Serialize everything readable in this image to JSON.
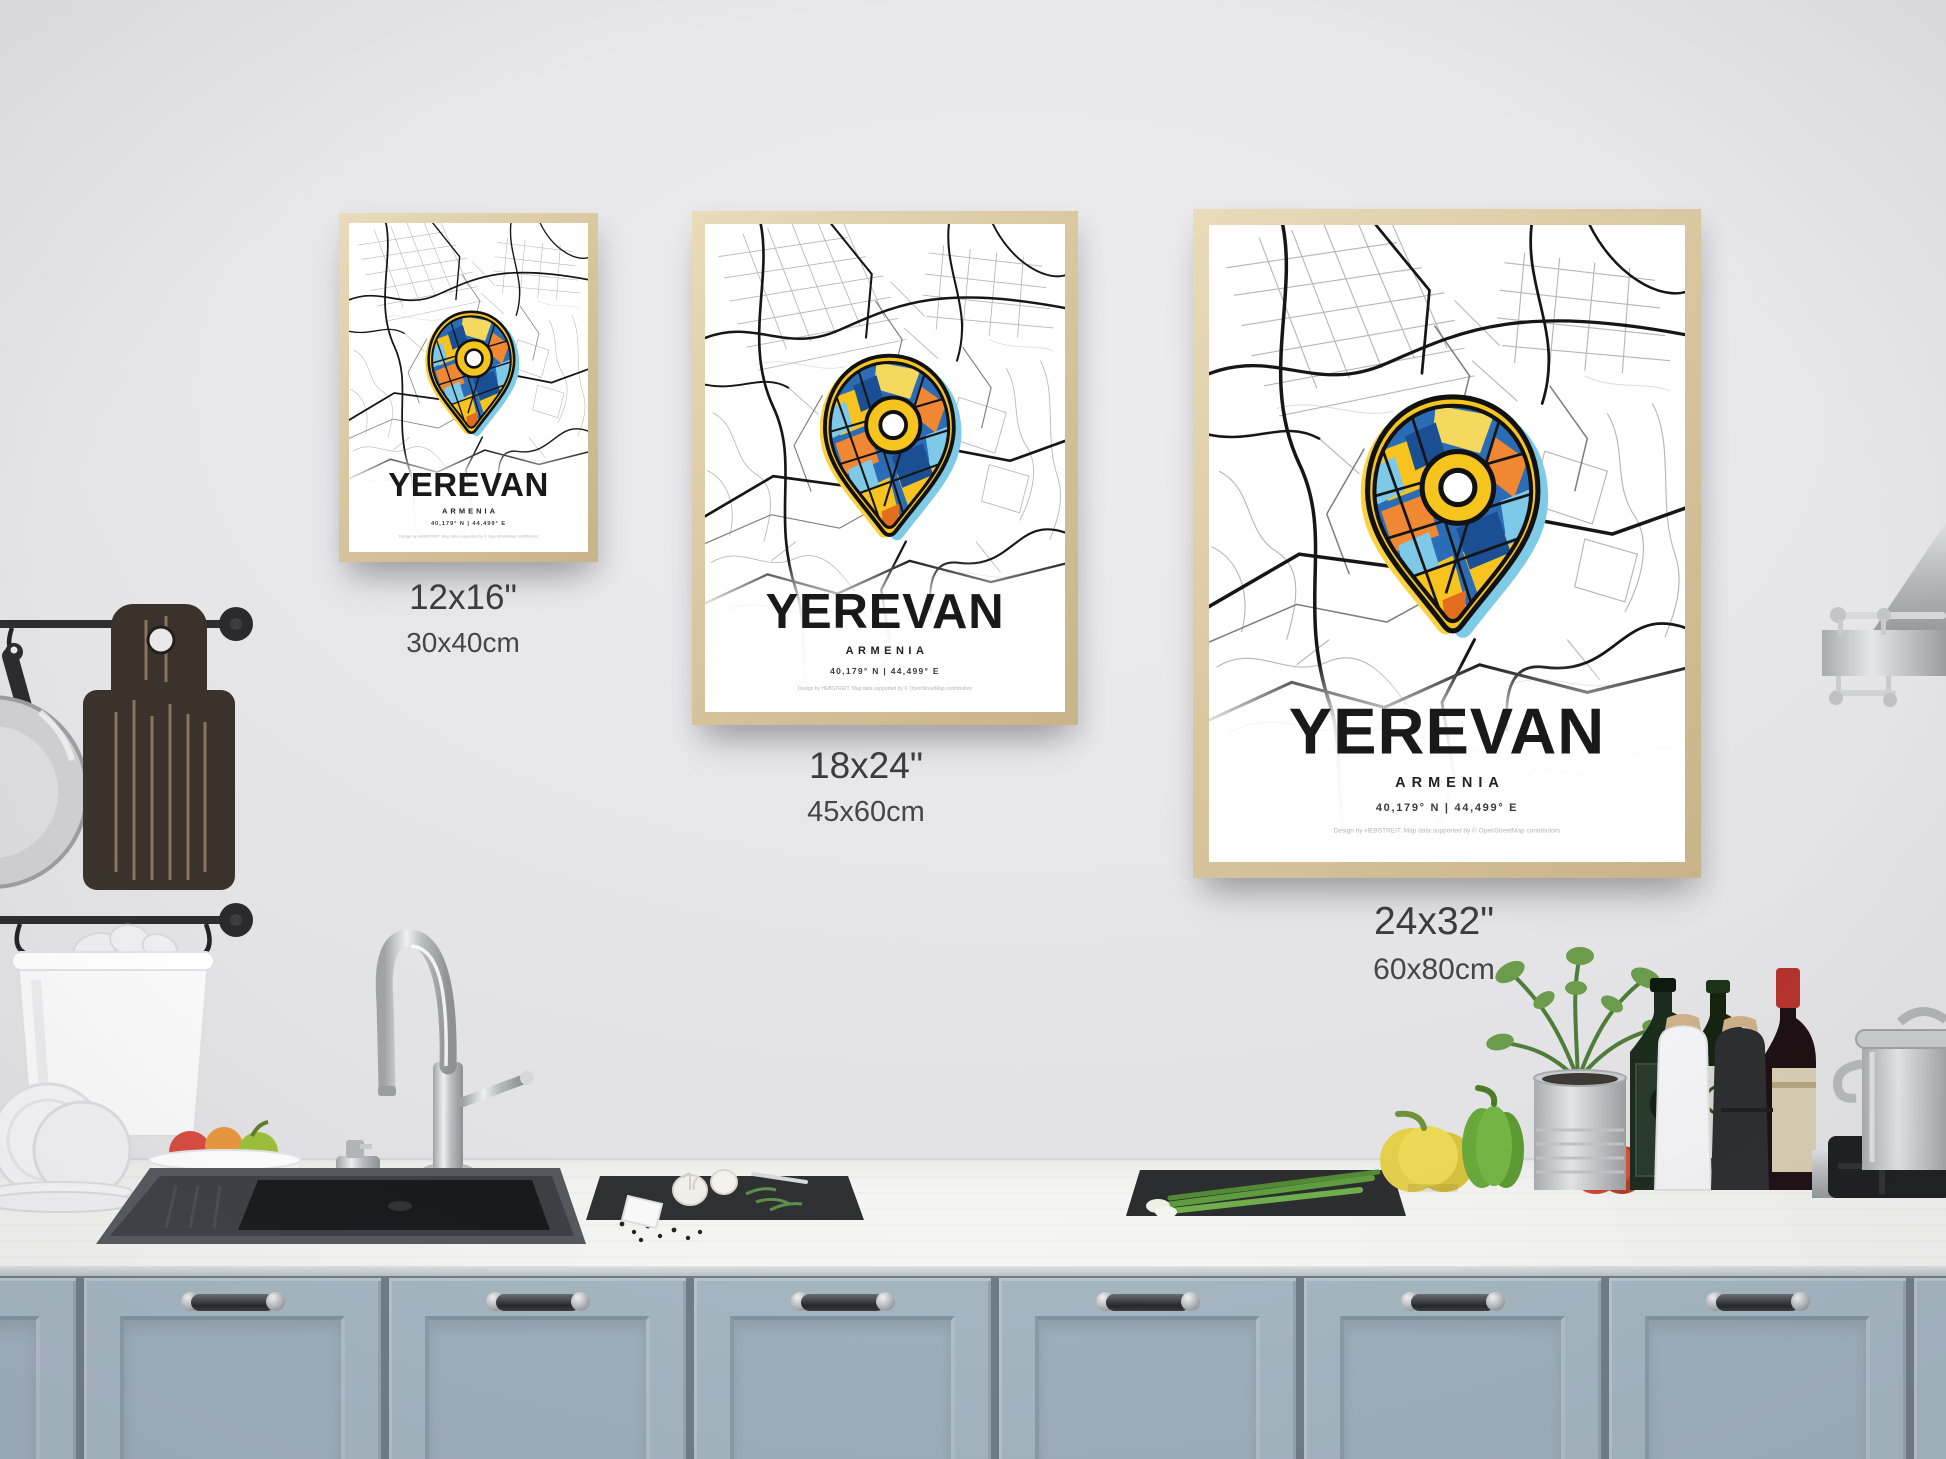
{
  "poster": {
    "title": "YEREVAN",
    "country": "ARMENIA",
    "coordinates": "40,179° N | 44,499° E",
    "credit": "Design by HEBSTREIT. Map data supported by © OpenStreetMap contributors"
  },
  "size_labels": [
    {
      "inches": "12x16\"",
      "cm": "30x40cm"
    },
    {
      "inches": "18x24\"",
      "cm": "45x60cm"
    },
    {
      "inches": "24x32\"",
      "cm": "60x80cm"
    }
  ],
  "colors": {
    "wall": "#e9e9eb",
    "frame_wood": "#d9c7a0",
    "cabinet_blue_gray": "#a6b7c2",
    "counter_white": "#f4f4f2",
    "pin_yellow": "#f6c51d",
    "pin_orange": "#ef8733",
    "pin_blue": "#2a6db6",
    "pin_light_blue": "#7ec8e8",
    "map_street_dark": "#161616",
    "label_text": "#3c3c3e"
  }
}
